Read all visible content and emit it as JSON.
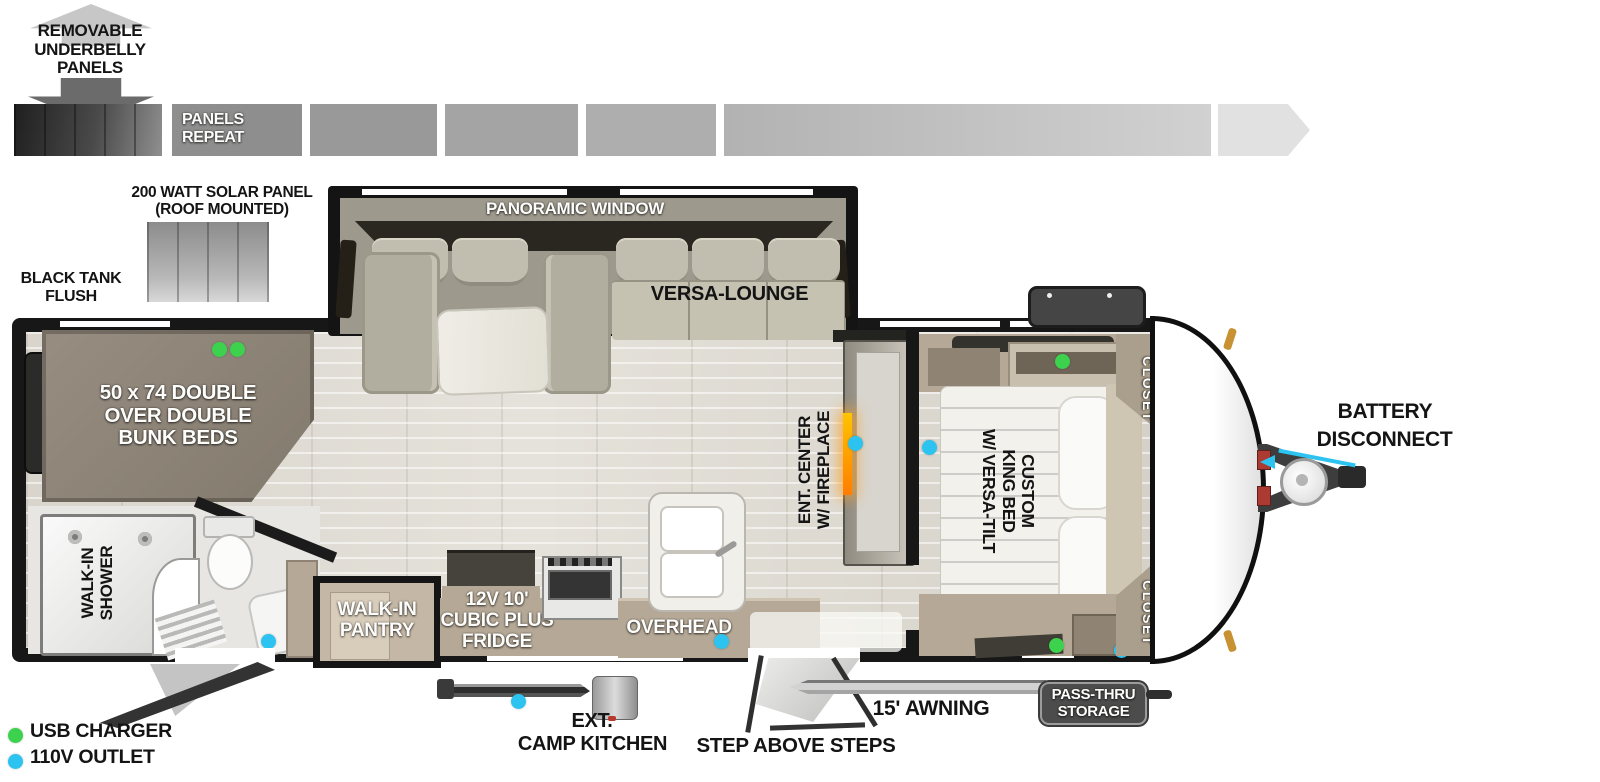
{
  "colors": {
    "usb_green": "#3dd24d",
    "outlet_blue": "#2cc3f0",
    "fireplace_orange": "#ff8c00",
    "wall_black": "#171717",
    "cabinet_tan": "#b5a896",
    "bed_brown": "#8d8377"
  },
  "underbelly_note": {
    "line1": "REMOVABLE",
    "line2": "UNDERBELLY",
    "line3": "PANELS"
  },
  "panels_strip": {
    "label_line1": "PANELS",
    "label_line2": "REPEAT"
  },
  "solar": {
    "line1": "200 WATT SOLAR PANEL",
    "line2": "(ROOF MOUNTED)"
  },
  "black_tank": {
    "line1": "BLACK TANK",
    "line2": "FLUSH"
  },
  "slide": {
    "window_label": "PANORAMIC WINDOW",
    "lounge_label": "VERSA-LOUNGE"
  },
  "bunk": {
    "line1": "50 x 74 DOUBLE",
    "line2": "OVER DOUBLE",
    "line3": "BUNK BEDS"
  },
  "bath": {
    "shower_line1": "WALK-IN",
    "shower_line2": "SHOWER"
  },
  "kitchen": {
    "pantry_line1": "WALK-IN",
    "pantry_line2": "PANTRY",
    "fridge_line1": "12V 10'",
    "fridge_line2": "CUBIC PLUS",
    "fridge_line3": "FRIDGE",
    "overhead": "OVERHEAD"
  },
  "ent_center": {
    "line1": "ENT. CENTER",
    "line2": "W/ FIREPLACE"
  },
  "bedroom": {
    "bed_line1": "CUSTOM",
    "bed_line2": "KING BED",
    "bed_line3": "W/ VERSA-TILT",
    "closet_top": "CLOSET",
    "closet_bottom": "CLOSET"
  },
  "exterior": {
    "battery_line1": "BATTERY",
    "battery_line2": "DISCONNECT",
    "camp_line1": "EXT.",
    "camp_line2": "CAMP KITCHEN",
    "steps_label": "STEP ABOVE STEPS",
    "awning_label": "15' AWNING",
    "passthru_line1": "PASS-THRU",
    "passthru_line2": "STORAGE"
  },
  "legend": {
    "usb": "USB CHARGER",
    "outlet": "110V OUTLET"
  }
}
